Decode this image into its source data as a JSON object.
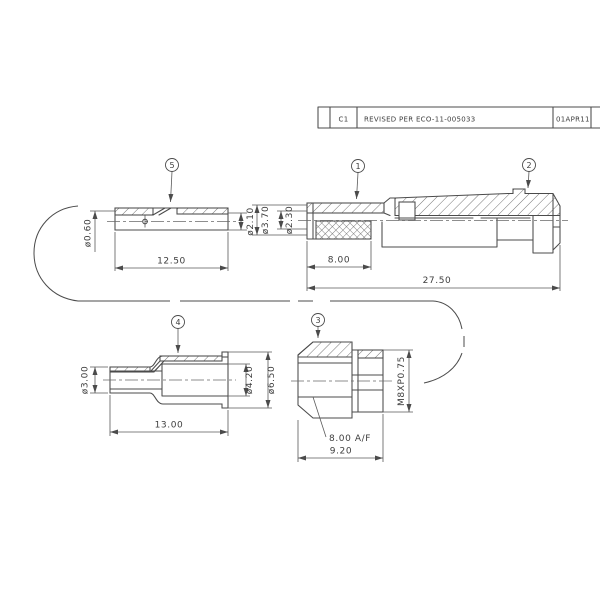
{
  "drawing": {
    "revision_block": {
      "rev": "C1",
      "description": "REVISED PER ECO-11-005033",
      "date": "01APR11"
    },
    "balloons": {
      "item1": "1",
      "item2": "2",
      "item3": "3",
      "item4": "4",
      "item5": "5"
    },
    "item5": {
      "length": "12.50",
      "crimp_dia": "ø0.60",
      "od": "ø2.10"
    },
    "assembly": {
      "crimp_length": "8.00",
      "overall_length": "27.50",
      "ferrule_od": "ø3.70",
      "cable_entry_id": "ø2.30"
    },
    "item4": {
      "length": "13.00",
      "entry_od": "ø3.00",
      "bore_id": "ø4.20",
      "od": "ø6.50"
    },
    "item3": {
      "length": "9.20",
      "thread": "M8XP0.75",
      "hex_af": "8.00 A/F"
    },
    "colors": {
      "line": "#4b4b4b",
      "text": "#3d3d3d",
      "background": "#ffffff"
    }
  }
}
